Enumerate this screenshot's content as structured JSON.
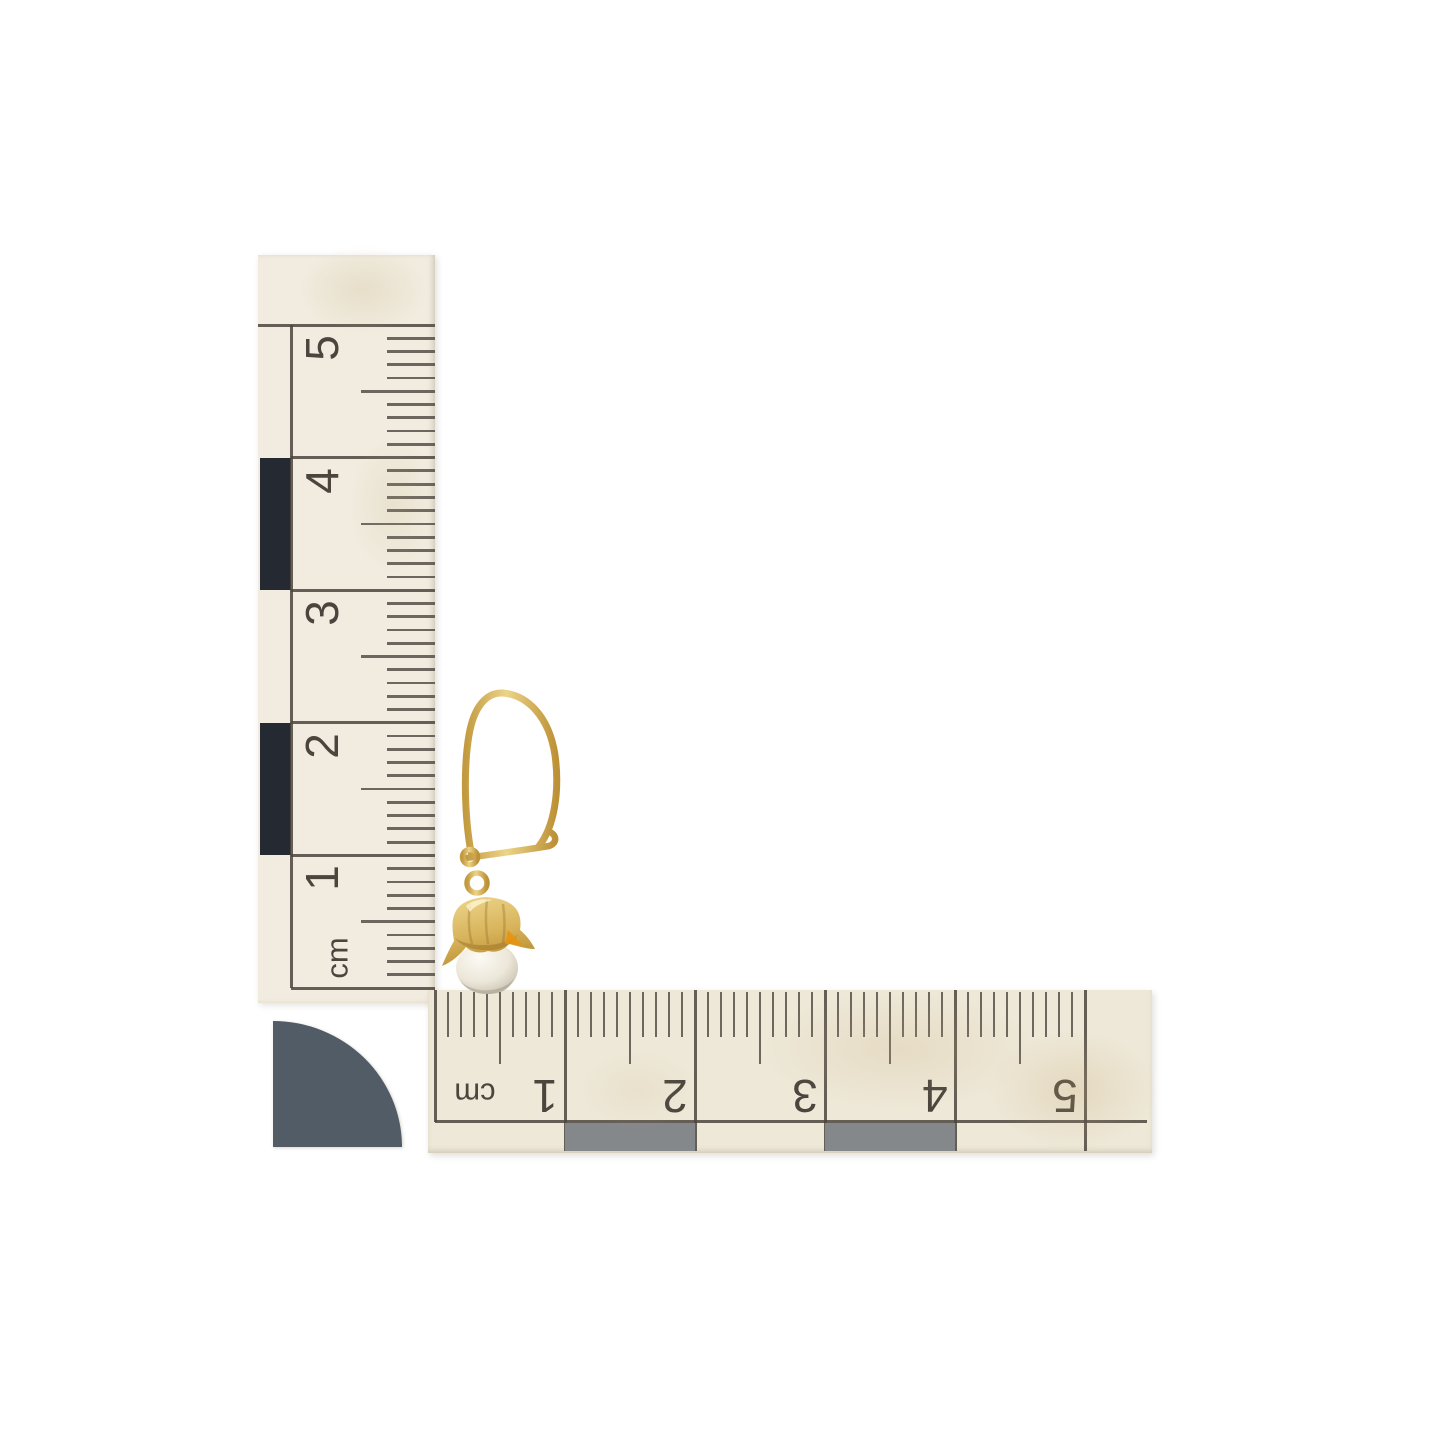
{
  "photo": {
    "background_color": "#ffffff",
    "subject": "gold kidney-wire earring with pearl drop on cm measuring scales"
  },
  "vertical_ruler": {
    "unit_label": "cm",
    "numbers": [
      "5",
      "4",
      "3",
      "2",
      "1"
    ],
    "paper_color": "#f1ecdf",
    "ink_color": "#4b453e",
    "block_color": "#252a32"
  },
  "horizontal_ruler": {
    "unit_label": "cm",
    "numbers": [
      "1",
      "2",
      "3",
      "4",
      "5"
    ],
    "paper_color": "#eee8d8",
    "ink_color": "#4b453e",
    "block_color": "#85888b"
  },
  "corner_marker": {
    "color": "#515c66"
  },
  "earring": {
    "metal_color": "#d2ad55",
    "metal_dark": "#b08a38",
    "metal_light": "#f0dd9c",
    "accent_color": "#e89410",
    "pearl_color": "#f3efe5",
    "pearl_shadow": "#b9b1a0"
  }
}
